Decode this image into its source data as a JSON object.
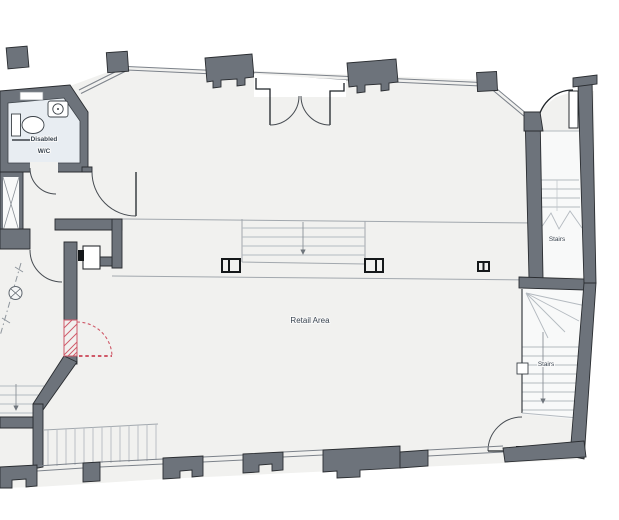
{
  "plan": {
    "labels": {
      "disabled_wc_line1": "Disabled",
      "disabled_wc_line2": "W/C",
      "retail_area": "Retail Area",
      "stairs_upper": "Stairs",
      "stairs_lower": "Stairs"
    },
    "icons": {
      "toilet": "toilet-icon",
      "sink": "sink-icon",
      "lift_cross": "lift-x-icon",
      "column_section": "column-symbol",
      "direction_arrow": "stair-direction-arrow"
    },
    "colors": {
      "background": "#ffffff",
      "wall": "#6d737b",
      "wall_outline": "#2a2d31",
      "floor": "#f1f1ef",
      "wc_floor": "#e8edf2",
      "stair_floor": "#f8f9f9",
      "window_line": "#7c828a",
      "step_line": "#a2a8ae",
      "tread_line": "#b4bac0",
      "door_line": "#1f2428",
      "opening_red": "#cf5968",
      "label_text": "#3a4550",
      "arrow": "#70767d"
    }
  }
}
